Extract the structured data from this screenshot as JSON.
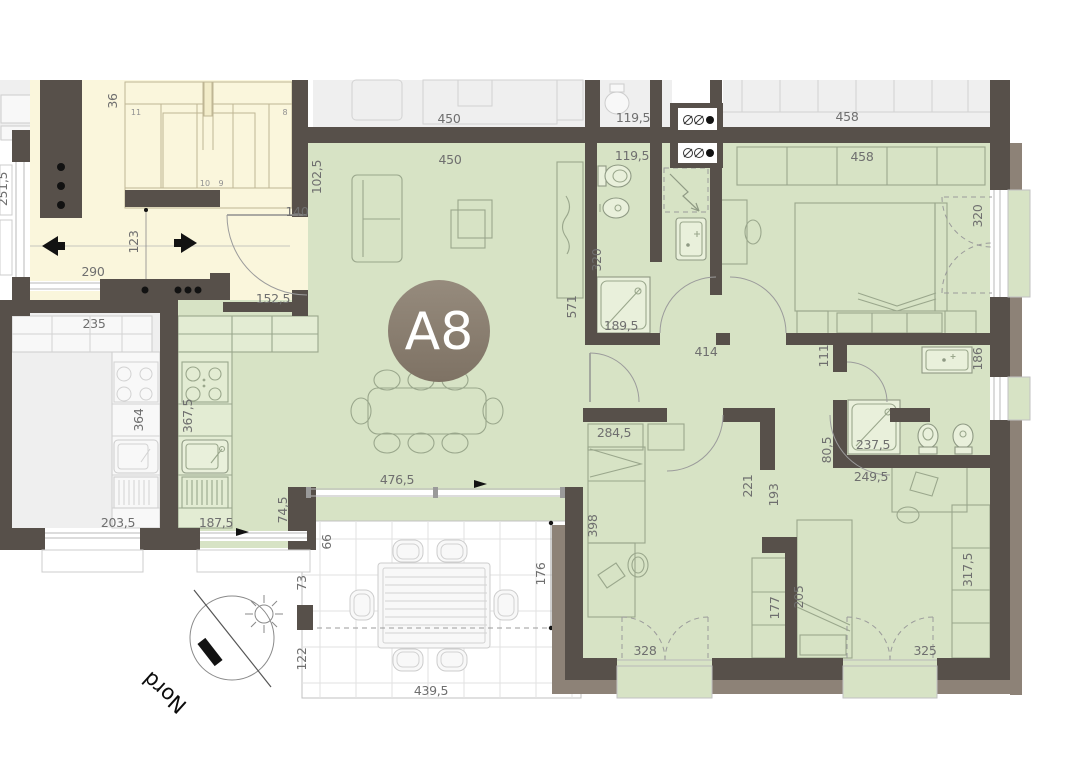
{
  "unit": {
    "label": "A8"
  },
  "compass": {
    "label": "Nord"
  },
  "stair": {
    "steps": [
      "11",
      "8",
      "10",
      "9"
    ]
  },
  "colors": {
    "wall": "#57504a",
    "wall_outer": "#8d8277",
    "room_green": "#d7e3c5",
    "landing_cream": "#faf6dc",
    "neighbor_gray": "#efefef",
    "badge_brown": "#8a7d6e"
  },
  "dims": {
    "neighbor_living_width": "450",
    "neighbor_bath_width": "119,5",
    "neighbor_hall_width": "458",
    "living_width": "450",
    "bath1_width": "119,5",
    "master_width": "458",
    "entry_wall": "102,5",
    "entry_door": "140",
    "kitchen_pass_wall": "152,5",
    "landing_width": "290",
    "landing_depth": "123",
    "neighbor_left_width": "251,5",
    "stair_width": "36",
    "neighbor_kitchen_width": "235",
    "neighbor_kitchen_depth": "364",
    "neighbor_kitchen_window": "203,5",
    "kitchen_depth": "367,5",
    "kitchen_window": "187,5",
    "kitchen_jog": "74,5",
    "living_glass_width": "476,5",
    "terrace_band": "66",
    "terrace_seg1": "73",
    "terrace_seg2": "122",
    "terrace_depth": "176",
    "terrace_width": "439,5",
    "living_length": "571",
    "bath1_length": "320",
    "shower1": "189,5",
    "corridor_width": "414",
    "master_window": "320",
    "corridor_stub": "111",
    "bath2_window": "186",
    "bedroom2_width": "284,5",
    "bedroom2_length": "398",
    "bedroom2_window": "328",
    "passage1": "221",
    "passage2": "193",
    "wardrobe1": "177",
    "wardrobe2": "205",
    "shower2": "237,5",
    "bath2_side": "80,5",
    "bath2_width": "249,5",
    "wardrobe3": "317,5",
    "bedroom3_window": "325"
  }
}
